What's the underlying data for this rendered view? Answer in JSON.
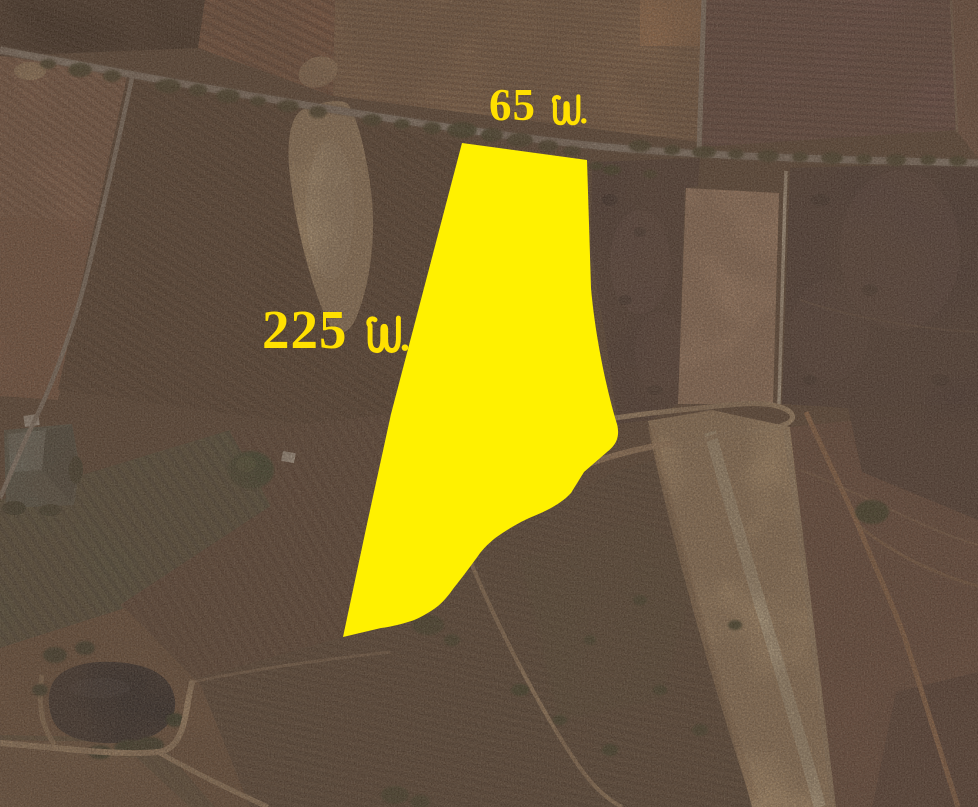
{
  "scene": {
    "type": "satellite-aerial-photo",
    "description": "Aerial satellite view of dry farmland plots with roads, ponds and a highlighted land parcel",
    "parcel_highlight_color": "#FFF100",
    "label_color": "#FFE000"
  },
  "labels": {
    "frontage": {
      "text": "65 ม.",
      "number": "65",
      "unit": "ม."
    },
    "depth": {
      "text": "225 ม.",
      "number": "225",
      "unit": "ม."
    }
  }
}
